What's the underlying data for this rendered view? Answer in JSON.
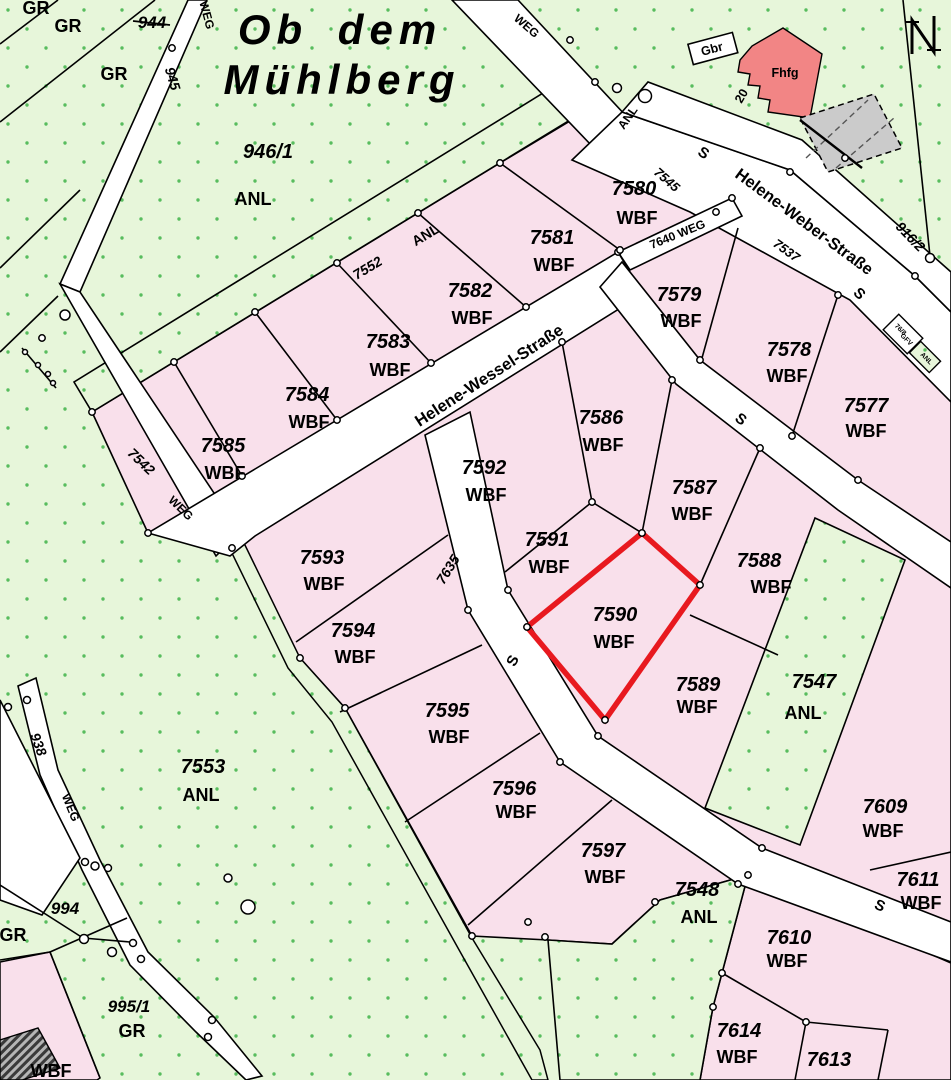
{
  "map": {
    "title": {
      "line1": "Ob dem",
      "line2": "Mühlberg",
      "color": "#9c3a3a"
    },
    "colors": {
      "green_base": "#e7f6da",
      "green_dot": "#58bd5e",
      "pink_parcel": "#f9e0eb",
      "street_white": "#ffffff",
      "boundary_black": "#000000",
      "highlight_red": "#e8191f",
      "building_red": "#f28585",
      "building_gray": "#cbcbcb",
      "title_red": "#9c3a3a"
    },
    "highlighted_parcel": {
      "number": "7590",
      "use": "WBF"
    },
    "north_arrow": "N",
    "labels": [
      {
        "t": "GR",
        "x": 36,
        "y": 14,
        "r": 0,
        "c": "use"
      },
      {
        "t": "GR",
        "x": 68,
        "y": 32,
        "r": 0,
        "c": "use"
      },
      {
        "t": "944",
        "x": 152,
        "y": 28,
        "r": 0,
        "c": "num17",
        "strike": true
      },
      {
        "t": "GR",
        "x": 114,
        "y": 80,
        "r": 0,
        "c": "use"
      },
      {
        "t": "945",
        "x": 168,
        "y": 80,
        "r": 73,
        "c": "num14"
      },
      {
        "t": "WEG",
        "x": 203,
        "y": 16,
        "r": 75,
        "c": "weg"
      },
      {
        "t": "946/1",
        "x": 268,
        "y": 158,
        "r": 0,
        "c": "num"
      },
      {
        "t": "ANL",
        "x": 253,
        "y": 205,
        "r": 0,
        "c": "use"
      },
      {
        "t": "7552",
        "x": 370,
        "y": 272,
        "r": -31,
        "c": "num14"
      },
      {
        "t": "ANL",
        "x": 428,
        "y": 239,
        "r": -31,
        "c": "use14"
      },
      {
        "t": "WEG",
        "x": 524,
        "y": 29,
        "r": 41,
        "c": "weg"
      },
      {
        "t": "ANL",
        "x": 631,
        "y": 120,
        "r": -55,
        "c": "use12"
      },
      {
        "t": "S",
        "x": 701,
        "y": 157,
        "r": 33,
        "c": "s"
      },
      {
        "t": "7545",
        "x": 664,
        "y": 183,
        "r": 41,
        "c": "num13"
      },
      {
        "t": "7640 WEG",
        "x": 679,
        "y": 238,
        "r": -22,
        "c": "weg"
      },
      {
        "t": "Helene-Weber-Straße",
        "x": 801,
        "y": 226,
        "r": 36.5,
        "c": "street"
      },
      {
        "t": "7537",
        "x": 784,
        "y": 254,
        "r": 36,
        "c": "num13"
      },
      {
        "t": "S",
        "x": 856,
        "y": 297,
        "r": 45,
        "c": "s"
      },
      {
        "t": "916/2",
        "x": 907,
        "y": 240,
        "r": 46,
        "c": "num14"
      },
      {
        "t": "Gbr",
        "x": 713,
        "y": 53,
        "r": -15,
        "c": "bldg"
      },
      {
        "t": "Fhfg",
        "x": 785,
        "y": 77,
        "r": 0,
        "c": "bldg"
      },
      {
        "t": "20",
        "x": 745,
        "y": 98,
        "r": -60,
        "c": "bldg"
      },
      {
        "t": "7580",
        "x": 634,
        "y": 195,
        "r": 0,
        "c": "num"
      },
      {
        "t": "WBF",
        "x": 637,
        "y": 224,
        "r": 0,
        "c": "use"
      },
      {
        "t": "7581",
        "x": 552,
        "y": 244,
        "r": 0,
        "c": "num"
      },
      {
        "t": "WBF",
        "x": 554,
        "y": 271,
        "r": 0,
        "c": "use"
      },
      {
        "t": "7582",
        "x": 470,
        "y": 297,
        "r": 0,
        "c": "num"
      },
      {
        "t": "WBF",
        "x": 472,
        "y": 324,
        "r": 0,
        "c": "use"
      },
      {
        "t": "7583",
        "x": 388,
        "y": 348,
        "r": 0,
        "c": "num"
      },
      {
        "t": "WBF",
        "x": 390,
        "y": 376,
        "r": 0,
        "c": "use"
      },
      {
        "t": "7584",
        "x": 307,
        "y": 401,
        "r": 0,
        "c": "num"
      },
      {
        "t": "WBF",
        "x": 309,
        "y": 428,
        "r": 0,
        "c": "use"
      },
      {
        "t": "7585",
        "x": 223,
        "y": 452,
        "r": 0,
        "c": "num"
      },
      {
        "t": "WBF",
        "x": 225,
        "y": 479,
        "r": 0,
        "c": "use"
      },
      {
        "t": "Helene-Wessel-Straße",
        "x": 492,
        "y": 380,
        "r": -33,
        "c": "street"
      },
      {
        "t": "7579",
        "x": 679,
        "y": 301,
        "r": 0,
        "c": "num"
      },
      {
        "t": "WBF",
        "x": 681,
        "y": 327,
        "r": 0,
        "c": "use"
      },
      {
        "t": "7578",
        "x": 789,
        "y": 356,
        "r": 0,
        "c": "num"
      },
      {
        "t": "WBF",
        "x": 787,
        "y": 382,
        "r": 0,
        "c": "use"
      },
      {
        "t": "7577",
        "x": 866,
        "y": 412,
        "r": 0,
        "c": "num"
      },
      {
        "t": "WBF",
        "x": 866,
        "y": 437,
        "r": 0,
        "c": "use"
      },
      {
        "t": "S",
        "x": 738,
        "y": 423,
        "r": 38,
        "c": "s"
      },
      {
        "t": "76/8",
        "x": 899,
        "y": 331,
        "r": 45,
        "c": "tiny"
      },
      {
        "t": "GFV",
        "x": 905,
        "y": 341,
        "r": 45,
        "c": "tiny"
      },
      {
        "t": "ANL",
        "x": 925,
        "y": 360,
        "r": 45,
        "c": "tiny"
      },
      {
        "t": "7586",
        "x": 601,
        "y": 424,
        "r": 0,
        "c": "num"
      },
      {
        "t": "WBF",
        "x": 603,
        "y": 451,
        "r": 0,
        "c": "use"
      },
      {
        "t": "7592",
        "x": 484,
        "y": 474,
        "r": 0,
        "c": "num"
      },
      {
        "t": "WBF",
        "x": 486,
        "y": 501,
        "r": 0,
        "c": "use"
      },
      {
        "t": "7587",
        "x": 694,
        "y": 494,
        "r": 0,
        "c": "num"
      },
      {
        "t": "WBF",
        "x": 692,
        "y": 520,
        "r": 0,
        "c": "use"
      },
      {
        "t": "7591",
        "x": 547,
        "y": 546,
        "r": 0,
        "c": "num"
      },
      {
        "t": "WBF",
        "x": 549,
        "y": 573,
        "r": 0,
        "c": "use"
      },
      {
        "t": "7588",
        "x": 759,
        "y": 567,
        "r": 0,
        "c": "num"
      },
      {
        "t": "WBF",
        "x": 771,
        "y": 593,
        "r": 0,
        "c": "use"
      },
      {
        "t": "7590",
        "x": 615,
        "y": 621,
        "r": 0,
        "c": "num"
      },
      {
        "t": "WBF",
        "x": 614,
        "y": 648,
        "r": 0,
        "c": "use"
      },
      {
        "t": "7589",
        "x": 698,
        "y": 691,
        "r": 0,
        "c": "num"
      },
      {
        "t": "WBF",
        "x": 697,
        "y": 713,
        "r": 0,
        "c": "use"
      },
      {
        "t": "7635",
        "x": 452,
        "y": 572,
        "r": -58,
        "c": "num14"
      },
      {
        "t": "S",
        "x": 517,
        "y": 663,
        "r": -62,
        "c": "s"
      },
      {
        "t": "7542",
        "x": 138,
        "y": 465,
        "r": 44,
        "c": "num14"
      },
      {
        "t": "WEG",
        "x": 178,
        "y": 511,
        "r": 44,
        "c": "weg"
      },
      {
        "t": "7593",
        "x": 322,
        "y": 564,
        "r": 0,
        "c": "num"
      },
      {
        "t": "WBF",
        "x": 324,
        "y": 590,
        "r": 0,
        "c": "use"
      },
      {
        "t": "7594",
        "x": 353,
        "y": 637,
        "r": 0,
        "c": "num"
      },
      {
        "t": "WBF",
        "x": 355,
        "y": 663,
        "r": 0,
        "c": "use"
      },
      {
        "t": "7595",
        "x": 447,
        "y": 717,
        "r": 0,
        "c": "num"
      },
      {
        "t": "WBF",
        "x": 449,
        "y": 743,
        "r": 0,
        "c": "use"
      },
      {
        "t": "7596",
        "x": 514,
        "y": 795,
        "r": 0,
        "c": "num"
      },
      {
        "t": "WBF",
        "x": 516,
        "y": 818,
        "r": 0,
        "c": "use"
      },
      {
        "t": "7597",
        "x": 603,
        "y": 857,
        "r": 0,
        "c": "num"
      },
      {
        "t": "WBF",
        "x": 605,
        "y": 883,
        "r": 0,
        "c": "use"
      },
      {
        "t": "7553",
        "x": 203,
        "y": 773,
        "r": 0,
        "c": "num"
      },
      {
        "t": "ANL",
        "x": 201,
        "y": 801,
        "r": 0,
        "c": "use"
      },
      {
        "t": "938",
        "x": 34,
        "y": 746,
        "r": 70,
        "c": "num14"
      },
      {
        "t": "WEG",
        "x": 67,
        "y": 809,
        "r": 68,
        "c": "weg"
      },
      {
        "t": "7547",
        "x": 814,
        "y": 688,
        "r": 0,
        "c": "num"
      },
      {
        "t": "ANL",
        "x": 803,
        "y": 719,
        "r": 0,
        "c": "use"
      },
      {
        "t": "7609",
        "x": 885,
        "y": 813,
        "r": 0,
        "c": "num"
      },
      {
        "t": "WBF",
        "x": 883,
        "y": 837,
        "r": 0,
        "c": "use"
      },
      {
        "t": "S",
        "x": 878,
        "y": 910,
        "r": 24,
        "c": "s"
      },
      {
        "t": "7548",
        "x": 697,
        "y": 896,
        "r": 0,
        "c": "num"
      },
      {
        "t": "ANL",
        "x": 699,
        "y": 923,
        "r": 0,
        "c": "use"
      },
      {
        "t": "7610",
        "x": 789,
        "y": 944,
        "r": 0,
        "c": "num"
      },
      {
        "t": "WBF",
        "x": 787,
        "y": 967,
        "r": 0,
        "c": "use"
      },
      {
        "t": "7611",
        "x": 918,
        "y": 886,
        "r": 0,
        "c": "num"
      },
      {
        "t": "WBF",
        "x": 921,
        "y": 909,
        "r": 0,
        "c": "use"
      },
      {
        "t": "7614",
        "x": 739,
        "y": 1037,
        "r": 0,
        "c": "num"
      },
      {
        "t": "WBF",
        "x": 737,
        "y": 1063,
        "r": 0,
        "c": "use"
      },
      {
        "t": "7613",
        "x": 829,
        "y": 1066,
        "r": 0,
        "c": "num"
      },
      {
        "t": "994",
        "x": 65,
        "y": 914,
        "r": 0,
        "c": "num17"
      },
      {
        "t": "GR",
        "x": 13,
        "y": 941,
        "r": 0,
        "c": "use"
      },
      {
        "t": "995/1",
        "x": 129,
        "y": 1012,
        "r": 0,
        "c": "num17"
      },
      {
        "t": "GR",
        "x": 132,
        "y": 1037,
        "r": 0,
        "c": "use"
      },
      {
        "t": "WBF",
        "x": 51,
        "y": 1077,
        "r": 0,
        "c": "use"
      }
    ],
    "circles": [
      [
        172,
        48
      ],
      [
        65,
        315,
        5
      ],
      [
        42,
        338
      ],
      [
        25,
        352,
        2.5
      ],
      [
        38,
        365,
        2.5
      ],
      [
        48,
        374,
        2.5
      ],
      [
        53,
        383,
        2.5
      ],
      [
        570,
        40
      ],
      [
        595,
        82
      ],
      [
        617,
        88,
        4.5
      ],
      [
        645,
        96,
        6.5
      ],
      [
        526,
        307
      ],
      [
        431,
        363
      ],
      [
        337,
        420
      ],
      [
        242,
        476
      ],
      [
        148,
        533
      ],
      [
        418,
        213
      ],
      [
        337,
        263
      ],
      [
        255,
        312
      ],
      [
        174,
        362
      ],
      [
        92,
        412
      ],
      [
        500,
        163
      ],
      [
        618,
        252
      ],
      [
        716,
        212
      ],
      [
        620,
        250
      ],
      [
        732,
        198
      ],
      [
        790,
        172
      ],
      [
        915,
        276
      ],
      [
        930,
        258,
        4.5
      ],
      [
        845,
        158
      ],
      [
        700,
        360
      ],
      [
        838,
        295
      ],
      [
        858,
        480
      ],
      [
        792,
        436
      ],
      [
        592,
        502
      ],
      [
        642,
        533
      ],
      [
        700,
        585
      ],
      [
        527,
        627
      ],
      [
        605,
        720
      ],
      [
        562,
        342
      ],
      [
        672,
        380
      ],
      [
        760,
        448
      ],
      [
        468,
        610
      ],
      [
        508,
        590
      ],
      [
        560,
        762
      ],
      [
        598,
        736
      ],
      [
        738,
        884
      ],
      [
        762,
        848
      ],
      [
        232,
        548
      ],
      [
        300,
        658
      ],
      [
        345,
        708
      ],
      [
        472,
        936
      ],
      [
        528,
        922
      ],
      [
        545,
        937
      ],
      [
        655,
        902
      ],
      [
        722,
        973
      ],
      [
        713,
        1007
      ],
      [
        748,
        875
      ],
      [
        806,
        1022
      ],
      [
        84,
        939,
        4.5
      ],
      [
        112,
        952,
        4.5
      ],
      [
        133,
        943,
        3.5
      ],
      [
        141,
        959,
        3.5
      ],
      [
        212,
        1020,
        3.5
      ],
      [
        208,
        1037,
        3.5
      ],
      [
        95,
        866,
        4
      ],
      [
        85,
        862,
        3.5
      ],
      [
        108,
        868,
        3.5
      ],
      [
        27,
        700,
        3.5
      ],
      [
        8,
        707,
        3.5
      ],
      [
        228,
        878,
        4
      ],
      [
        248,
        907,
        7
      ]
    ]
  }
}
